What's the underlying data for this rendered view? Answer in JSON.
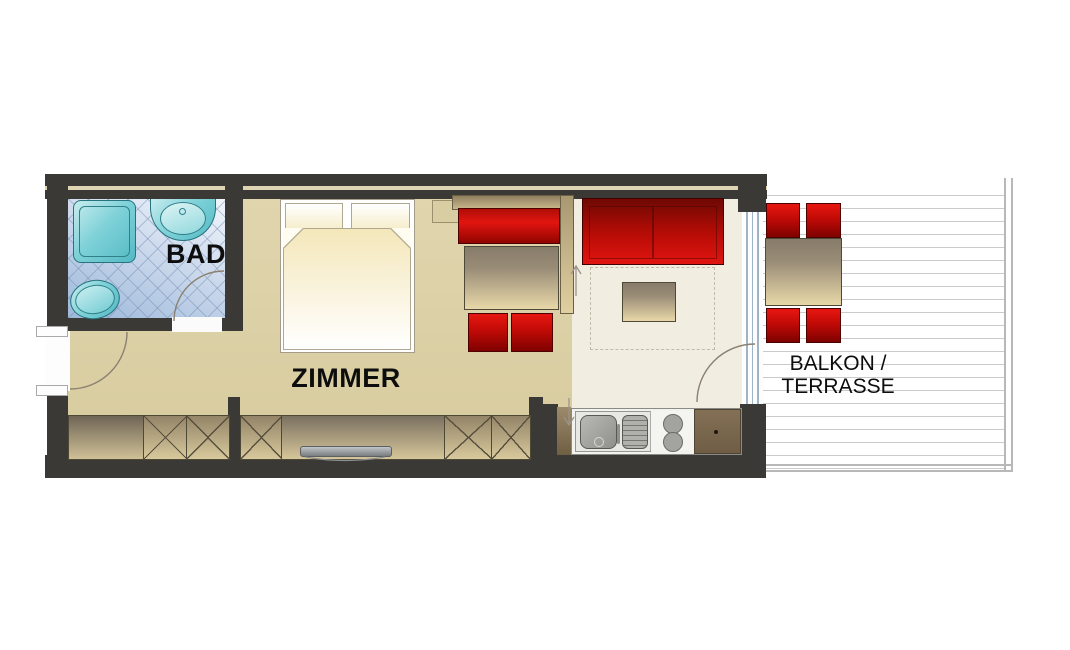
{
  "meta": {
    "type": "apartment-floor-plan",
    "width_px": 1070,
    "height_px": 650
  },
  "labels": {
    "bathroom": "BAD",
    "main_room": "ZIMMER",
    "balcony_line1": "BALKON /",
    "balcony_line2": "TERRASSE"
  },
  "colors": {
    "wall": "#3b3936",
    "wall_core_stripe": "#ded4b4",
    "main_room_floor": "#dcd1a7",
    "living_floor": "#f1ede0",
    "bathroom_tile": "#b7cbe3",
    "fixture_teal": "#7fd2d8",
    "furniture_red": "#d9100b",
    "furniture_red_dark": "#8c0400",
    "table_wood_dark": "#8d8170",
    "table_wood_light": "#ead9a6",
    "kitchen_cabinet_brown": "#7c6950",
    "deck_plank_line": "#cacaca",
    "label_text": "#0d0d0d"
  },
  "rooms": [
    "BAD",
    "ZIMMER",
    "BALKON / TERRASSE"
  ],
  "furniture_items": [
    "shower",
    "washbasin",
    "toilet",
    "double-bed",
    "pillows",
    "duvet",
    "nightstand",
    "corner-bench",
    "dining-table",
    "dining-chairs",
    "sofa",
    "coffee-table",
    "rug-outline",
    "wardrobe-closets",
    "sideboard",
    "tv",
    "kitchen-sink",
    "drainboard",
    "stove",
    "kitchen-cabinet",
    "balcony-table",
    "balcony-chairs",
    "entry-door",
    "bathroom-door",
    "balcony-glass-door"
  ]
}
